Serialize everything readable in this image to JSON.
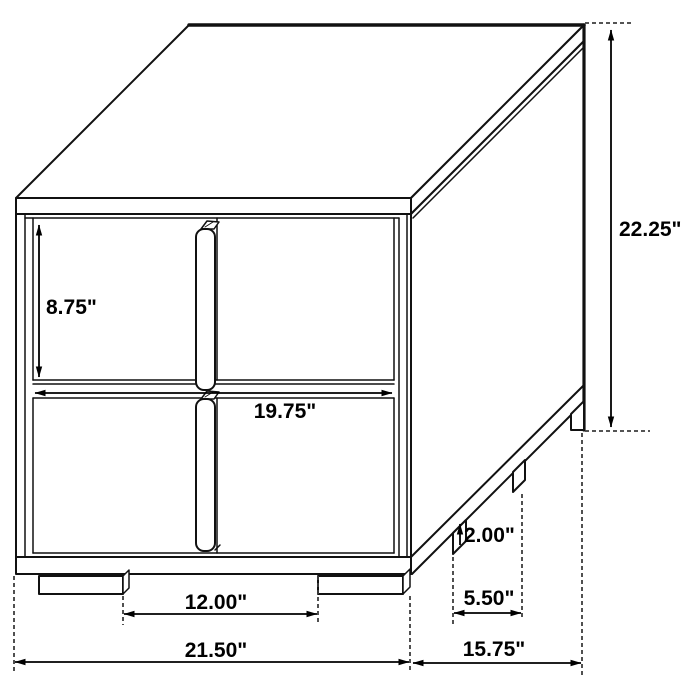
{
  "diagram": {
    "labels": {
      "drawer_height": "8.75\"",
      "drawer_width": "19.75\"",
      "overall_height": "22.25\"",
      "leg_height": "2.00\"",
      "side_leg_spacing": "5.50\"",
      "front_leg_spacing": "12.00\"",
      "overall_width": "21.50\"",
      "overall_depth": "15.75\""
    }
  }
}
